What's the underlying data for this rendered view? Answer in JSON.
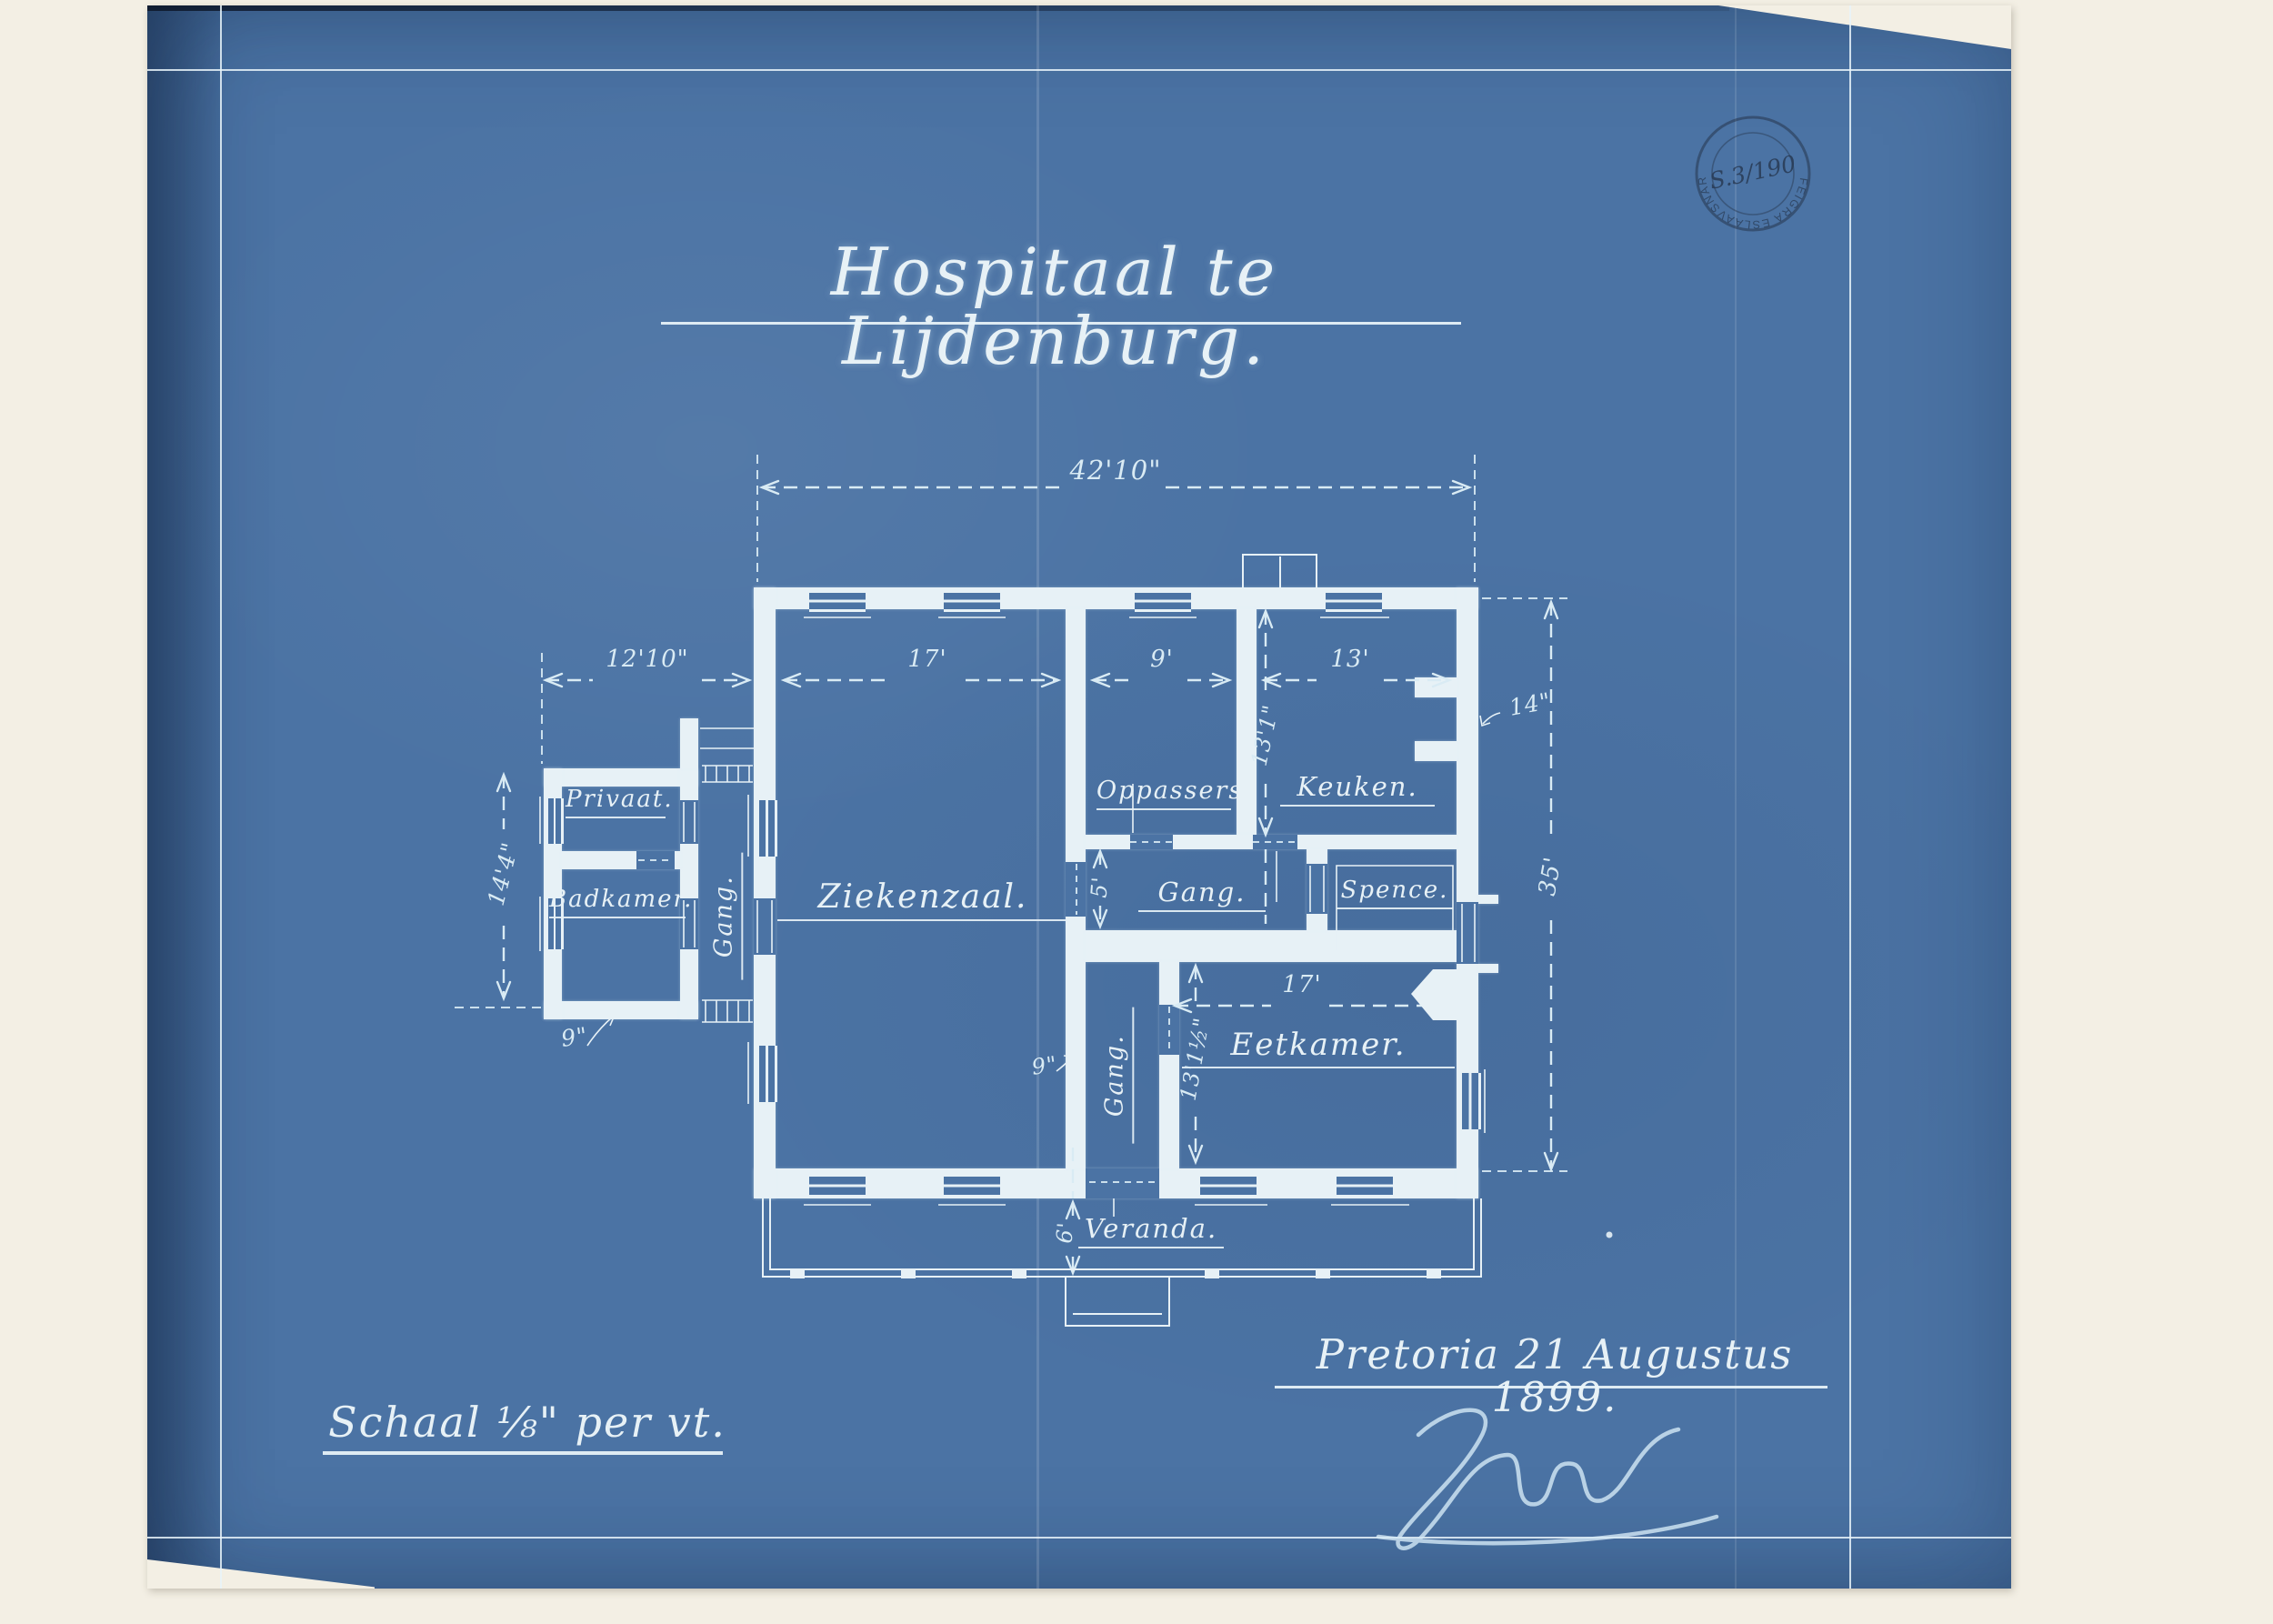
{
  "title": "Hospitaal te Lijdenburg.",
  "stamp": {
    "number": "S.3/190",
    "arc": "TRANSVAALSE ARGIEF"
  },
  "rooms": {
    "privaat": "Privaat.",
    "badkamer": "Badkamer.",
    "gang_west": "Gang.",
    "ziekenzaal": "Ziekenzaal.",
    "oppassers": "Oppassers.",
    "keuken": "Keuken.",
    "gang_mid": "Gang.",
    "spence": "Spence.",
    "gang_south": "Gang.",
    "eetkamer": "Eetkamer.",
    "veranda": "Veranda."
  },
  "dims": {
    "overall_width": "42'10\"",
    "annex_width": "12'10\"",
    "ziekenzaal_width": "17'",
    "oppassers_width": "9'",
    "keuken_width": "13'",
    "annex_depth": "14'4\"",
    "keuken_depth": "13'1\"",
    "building_depth": "35'",
    "gang_mid_width": "5'",
    "eetkamer_width": "17'",
    "eetkamer_depth": "13'1½\"",
    "veranda_depth": "6'",
    "wall_annex": "9\"",
    "wall_gang": "9\"",
    "wall_right": "14\""
  },
  "footer": {
    "scale": "Schaal ⅛\" per vt.",
    "place_date": "Pretoria 21 Augustus 1899."
  }
}
